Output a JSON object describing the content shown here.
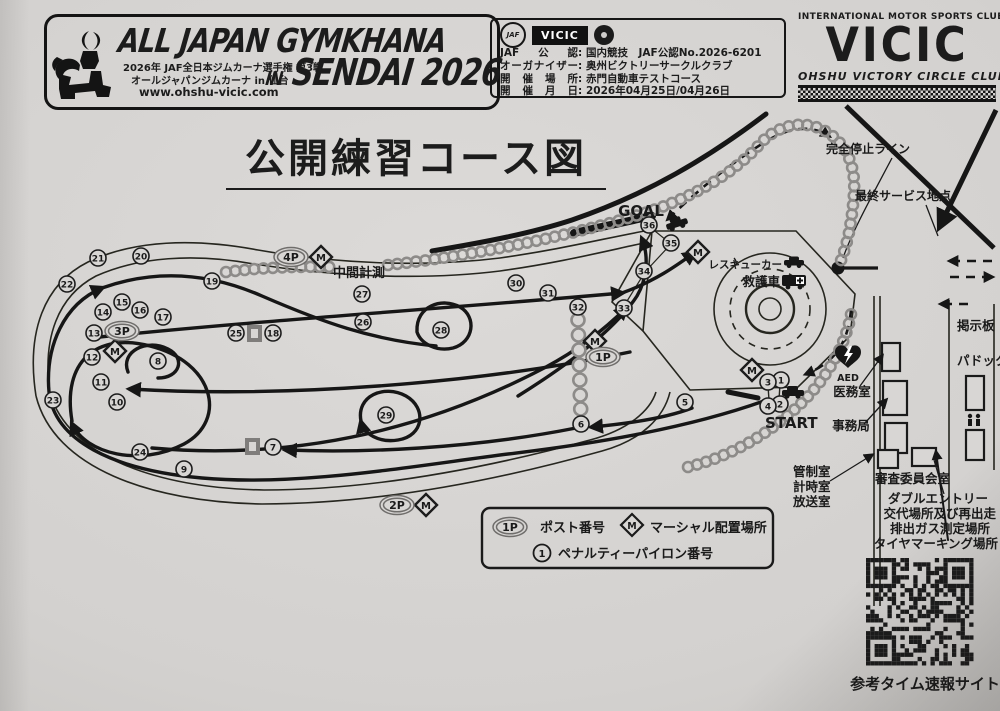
{
  "banner": {
    "title_line1": "ALL JAPAN GYMKHANA",
    "title_in": "IN",
    "title_line2": "SENDAI 2026",
    "sub1": "2026年 JAF全日本ジムカーナ選手権 第3戦",
    "sub2": "オールジャパンジムカーナ in 仙台",
    "url": "www.ohshu-vicic.com"
  },
  "sanction": {
    "vicic_badge": "VICIC",
    "jaf_badge": "JAF",
    "rows": [
      {
        "label": "JAF公認",
        "value": "国内競技　JAF公認No.2026-6201"
      },
      {
        "label": "オーガナイザー",
        "value": "奥州ビクトリーサークルクラブ"
      },
      {
        "label": "開催場所",
        "value": "赤門自動車テストコース"
      },
      {
        "label": "開催月日",
        "value": "2026年04月25日/04月26日"
      }
    ]
  },
  "club": {
    "top": "INTERNATIONAL MOTOR SPORTS CLUB",
    "name": "VICIC",
    "bottom": "OHSHU  VICTORY  CIRCLE  CLUB"
  },
  "title": "公開練習コース図",
  "course": {
    "goal": "GOAL",
    "start": "START",
    "intermediate": "中間計測",
    "full_stop_line": "完全停止ライン",
    "final_service": "最終サービス地点",
    "rescue_car": "レスキューカー",
    "ambulance": "救護車",
    "aed": "AED",
    "medical_room": "医務室",
    "office": "事務局",
    "control_room": "管制室",
    "timing_room": "計時室",
    "broadcast_room": "放送室",
    "stewards_room": "審査委員会室",
    "double_entry": [
      "ダブルエントリー",
      "交代場所及び再出走",
      "排出ガス測定場所",
      "タイヤマーキング場所"
    ],
    "notice_board": "掲示板",
    "paddock": "パドック",
    "posts": [
      {
        "label": "1P",
        "x": 603,
        "y": 357
      },
      {
        "label": "2P",
        "x": 397,
        "y": 505
      },
      {
        "label": "3P",
        "x": 122,
        "y": 331
      },
      {
        "label": "4P",
        "x": 291,
        "y": 257
      }
    ],
    "marshals": [
      {
        "x": 321,
        "y": 257
      },
      {
        "x": 115,
        "y": 351
      },
      {
        "x": 595,
        "y": 341
      },
      {
        "x": 698,
        "y": 252
      },
      {
        "x": 426,
        "y": 505
      },
      {
        "x": 752,
        "y": 370
      }
    ],
    "pylons": [
      {
        "n": 1,
        "x": 781,
        "y": 380
      },
      {
        "n": 2,
        "x": 780,
        "y": 404
      },
      {
        "n": 3,
        "x": 768,
        "y": 382
      },
      {
        "n": 4,
        "x": 768,
        "y": 406
      },
      {
        "n": 5,
        "x": 685,
        "y": 402
      },
      {
        "n": 6,
        "x": 581,
        "y": 424
      },
      {
        "n": 7,
        "x": 273,
        "y": 447
      },
      {
        "n": 8,
        "x": 158,
        "y": 361
      },
      {
        "n": 9,
        "x": 184,
        "y": 469
      },
      {
        "n": 10,
        "x": 117,
        "y": 402
      },
      {
        "n": 11,
        "x": 101,
        "y": 382
      },
      {
        "n": 12,
        "x": 92,
        "y": 357
      },
      {
        "n": 13,
        "x": 94,
        "y": 333
      },
      {
        "n": 14,
        "x": 103,
        "y": 312
      },
      {
        "n": 15,
        "x": 122,
        "y": 302
      },
      {
        "n": 16,
        "x": 140,
        "y": 310
      },
      {
        "n": 17,
        "x": 163,
        "y": 317
      },
      {
        "n": 18,
        "x": 273,
        "y": 333
      },
      {
        "n": 19,
        "x": 212,
        "y": 281
      },
      {
        "n": 20,
        "x": 141,
        "y": 256
      },
      {
        "n": 21,
        "x": 98,
        "y": 258
      },
      {
        "n": 22,
        "x": 67,
        "y": 284
      },
      {
        "n": 23,
        "x": 53,
        "y": 400
      },
      {
        "n": 24,
        "x": 140,
        "y": 452
      },
      {
        "n": 25,
        "x": 236,
        "y": 333
      },
      {
        "n": 26,
        "x": 363,
        "y": 322
      },
      {
        "n": 27,
        "x": 362,
        "y": 294
      },
      {
        "n": 28,
        "x": 441,
        "y": 330
      },
      {
        "n": 29,
        "x": 386,
        "y": 415
      },
      {
        "n": 30,
        "x": 516,
        "y": 283
      },
      {
        "n": 31,
        "x": 548,
        "y": 293
      },
      {
        "n": 32,
        "x": 578,
        "y": 307
      },
      {
        "n": 33,
        "x": 624,
        "y": 308
      },
      {
        "n": 34,
        "x": 644,
        "y": 271
      },
      {
        "n": 35,
        "x": 671,
        "y": 243
      },
      {
        "n": 36,
        "x": 649,
        "y": 225
      }
    ],
    "gray_squares": [
      {
        "x": 247,
        "y": 325
      },
      {
        "x": 245,
        "y": 438
      }
    ]
  },
  "legend": {
    "post_symbol": "1P",
    "post_text": "ポスト番号",
    "marshal_symbol": "M",
    "marshal_text": "マーシャル配置場所",
    "penalty_symbol": "1",
    "penalty_text": "ペナルティーパイロン番号"
  },
  "qr_caption": "参考タイム速報サイト"
}
